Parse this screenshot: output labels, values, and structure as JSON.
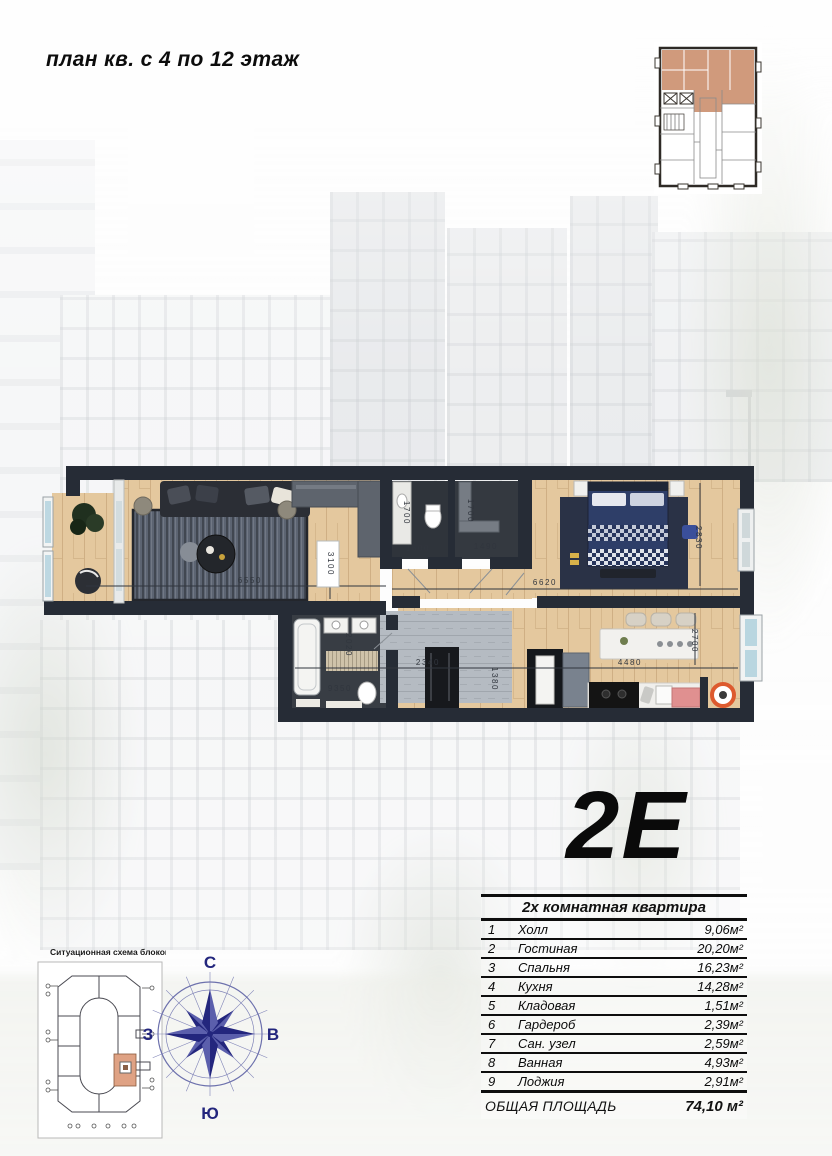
{
  "page": {
    "title": "план кв. с 4 по 12 этаж"
  },
  "unit": {
    "code": "2E"
  },
  "floor_plan": {
    "dims": {
      "living_width": "6550",
      "living_depth": "3100",
      "wc_depth": "1700",
      "wc_width": "1600",
      "storage_depth": "1700",
      "storage_width": "1490",
      "bedroom_width": "6620",
      "bedroom_depth": "2830",
      "bath_depth": "2020",
      "corridor_length": "9350",
      "hall_width": "2340",
      "niche_width": "1380",
      "kitchen_width": "4480",
      "kitchen_depth": "2700"
    }
  },
  "area_table": {
    "header": "2х комнатная квартира",
    "rows": [
      {
        "num": "1",
        "name": "Холл",
        "area": "9,06м²"
      },
      {
        "num": "2",
        "name": "Гостиная",
        "area": "20,20м²"
      },
      {
        "num": "3",
        "name": "Спальня",
        "area": "16,23м²"
      },
      {
        "num": "4",
        "name": "Кухня",
        "area": "14,28м²"
      },
      {
        "num": "5",
        "name": "Кладовая",
        "area": "1,51м²"
      },
      {
        "num": "6",
        "name": "Гардероб",
        "area": "2,39м²"
      },
      {
        "num": "7",
        "name": "Сан. узел",
        "area": "2,59м²"
      },
      {
        "num": "8",
        "name": "Ванная",
        "area": "4,93м²"
      },
      {
        "num": "9",
        "name": "Лоджия",
        "area": "2,91м²"
      }
    ],
    "total_label": "ОБЩАЯ ПЛОЩАДЬ",
    "total_area": "74,10 м²"
  },
  "situational_scheme": {
    "label": "Ситуационная схема блоков"
  },
  "compass": {
    "north": "С",
    "south": "Ю",
    "east": "В",
    "west": "З"
  },
  "colors": {
    "wall": "#262c36",
    "wood_floor": "#e4c89e",
    "highlight_salmon": "#d09a7c",
    "compass_navy": "#23267d",
    "accent_orange": "#dd5a2e",
    "accent_pink": "#e09090",
    "window_glass": "#bdd8e2"
  }
}
